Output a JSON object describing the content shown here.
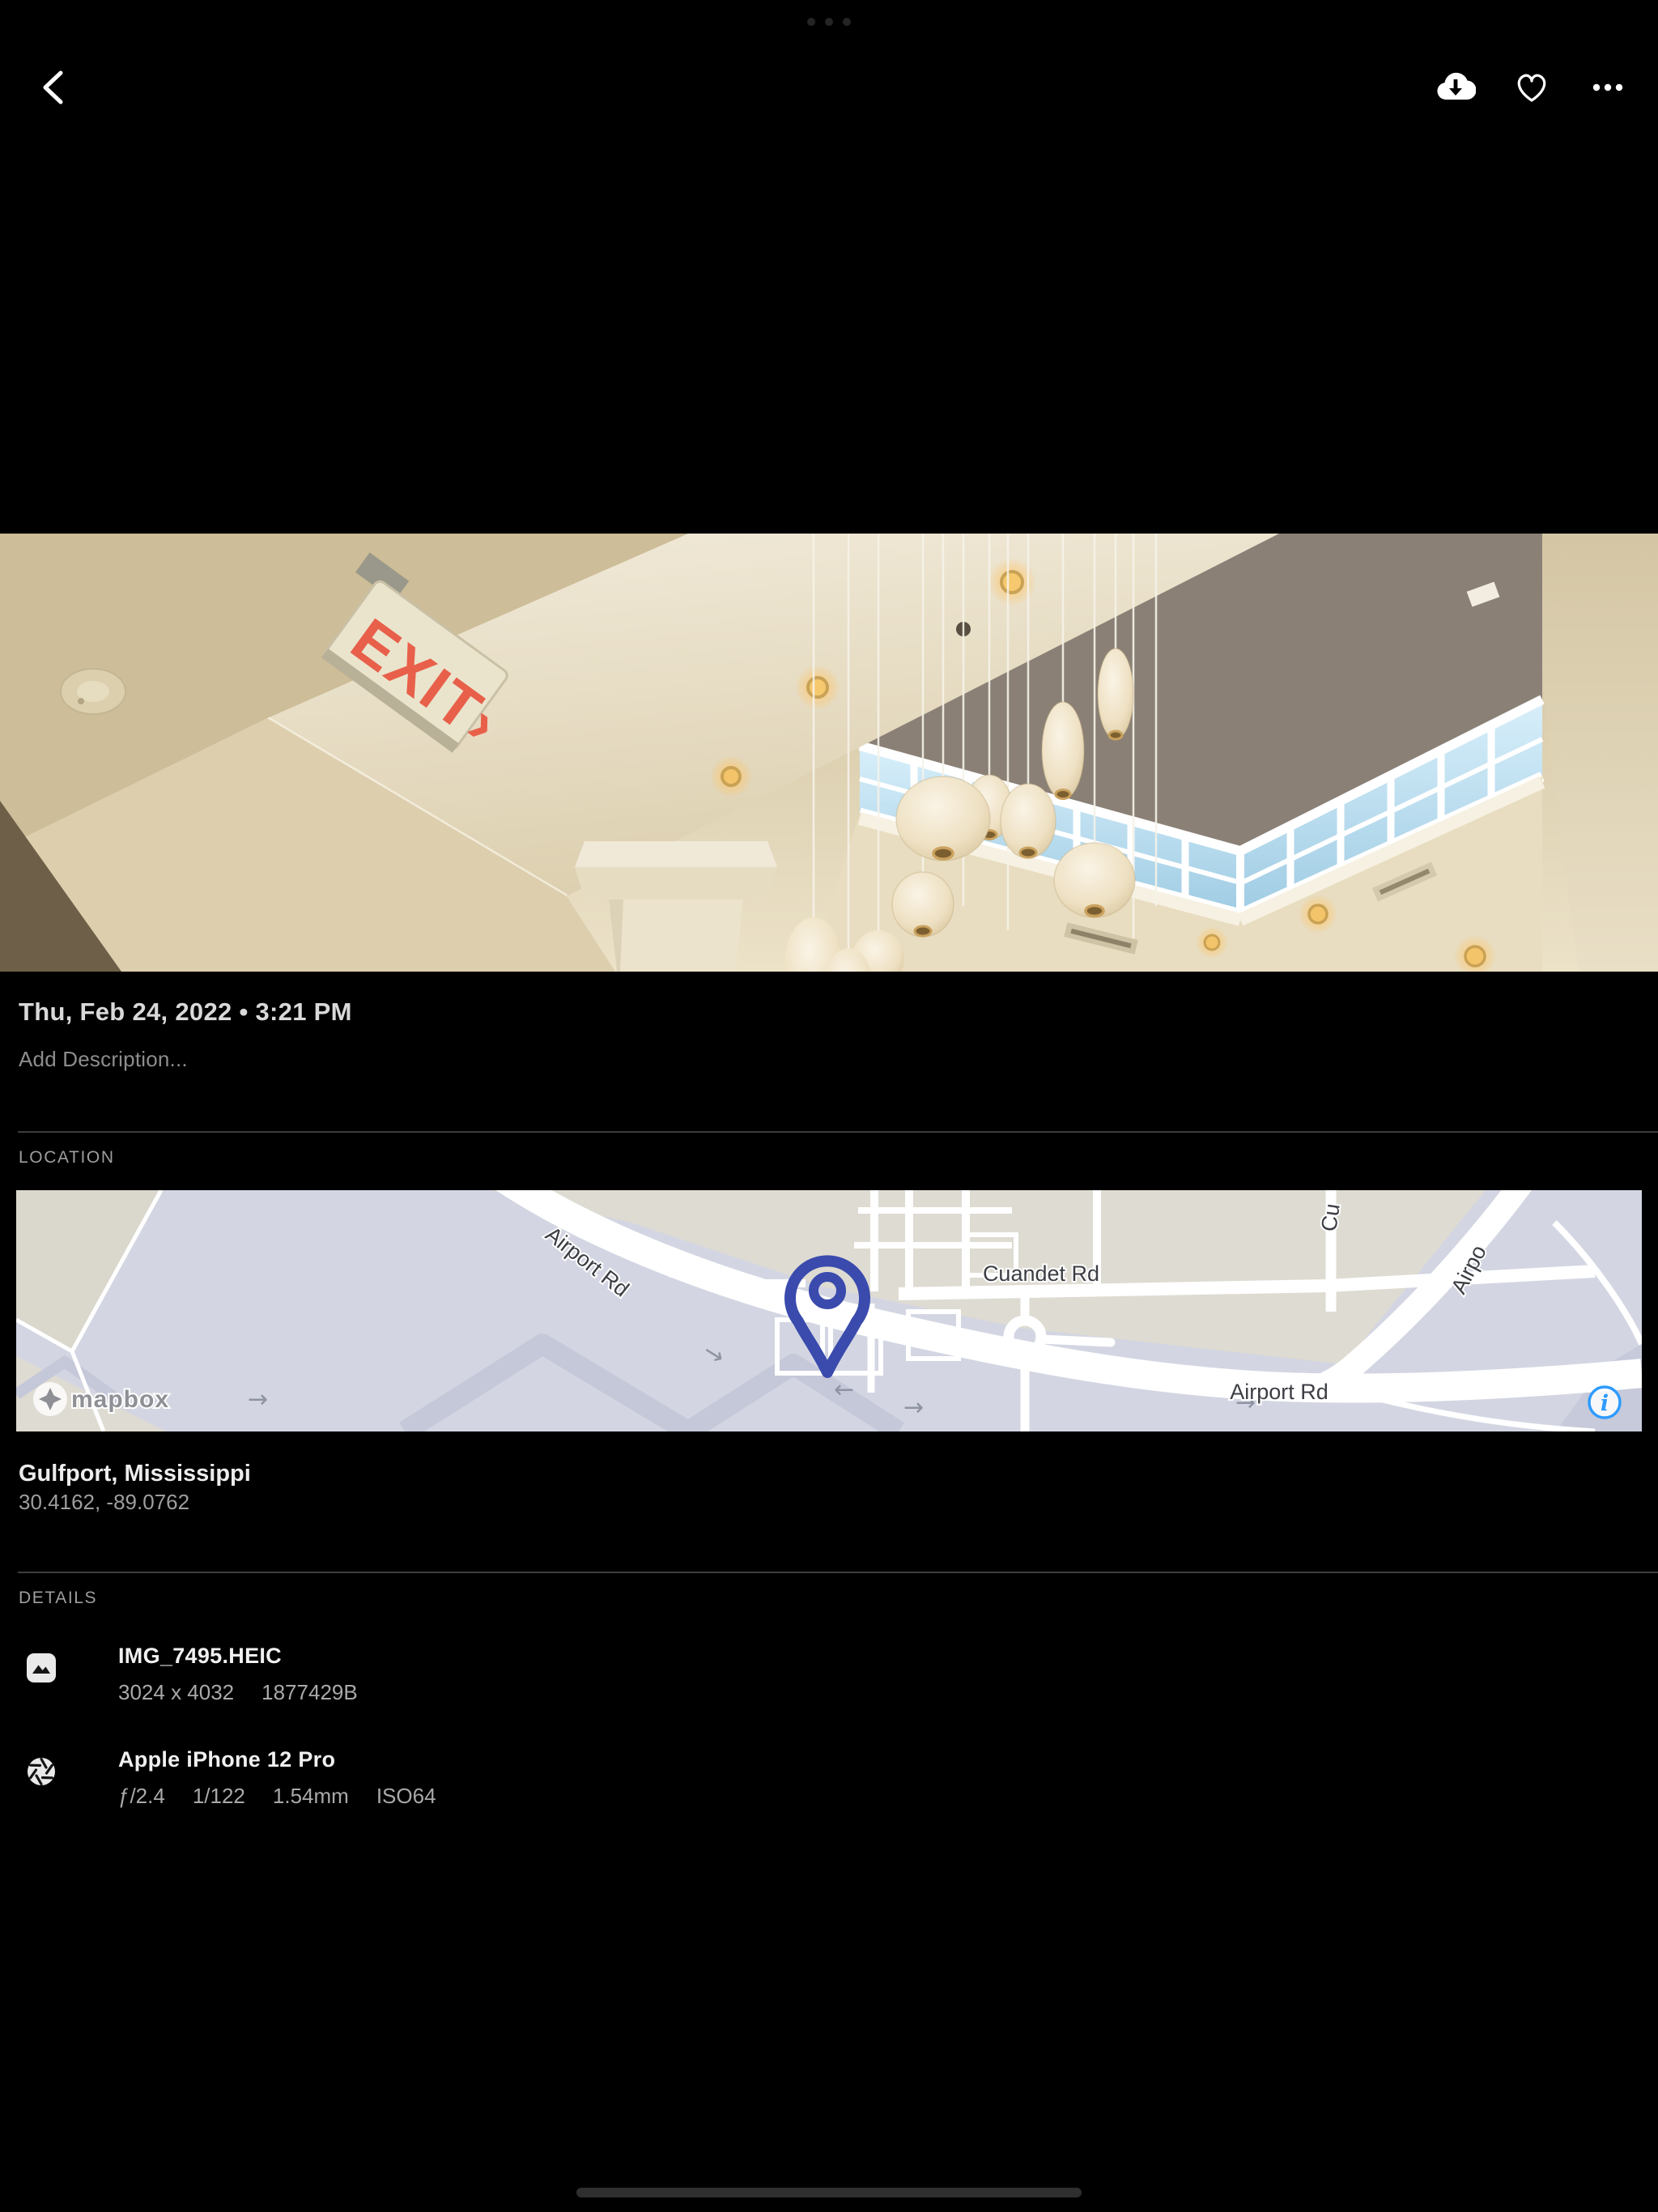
{
  "header": {
    "back_icon": "chevron-left",
    "download_icon": "cloud-download",
    "favorite_icon": "heart-outline",
    "more_icon": "ellipsis"
  },
  "photo": {
    "exit_sign_text": "EXIT›",
    "description": "ceiling of atrium with hanging bubble pendant lamps, clerestory windows and exit sign"
  },
  "meta": {
    "date_text": "Thu, Feb 24, 2022 • 3:21 PM",
    "description_placeholder": "Add Description..."
  },
  "location": {
    "section_label": "LOCATION",
    "place": "Gulfport, Mississippi",
    "coordinates": "30.4162, -89.0762",
    "map": {
      "label_airport_rd_diagonal": "Airport Rd",
      "label_cuandet_rd": "Cuandet Rd",
      "label_airport_rd_horizontal": "Airport Rd",
      "label_airport_partial": "Airpo",
      "label_cross_street_partial": "Cu",
      "mapbox_wordmark": "mapbox",
      "info_glyph": "i"
    }
  },
  "details": {
    "section_label": "DETAILS",
    "file": {
      "name": "IMG_7495.HEIC",
      "dimensions": "3024 x 4032",
      "size": "1877429B"
    },
    "camera": {
      "name": "Apple iPhone 12 Pro",
      "aperture": "ƒ/2.4",
      "shutter": "1/122",
      "focal_length": "1.54mm",
      "iso": "ISO64"
    }
  },
  "colors": {
    "pin_indigo": "#3a4bad",
    "info_blue": "#2e9bff",
    "exit_red": "#e8604a",
    "map_base": "#d3d6e2",
    "map_land_beige": "#dedbd2"
  }
}
